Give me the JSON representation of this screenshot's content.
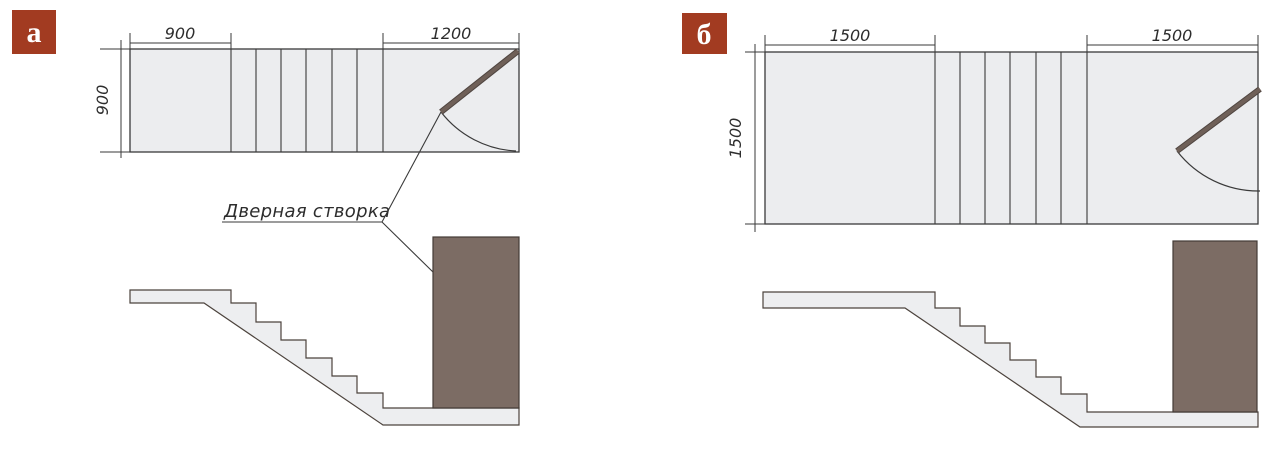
{
  "figures": [
    {
      "label": "а",
      "plan": {
        "dim_top_left": "900",
        "dim_top_right": "1200",
        "dim_left": "900"
      },
      "callout_label": "Дверная створка"
    },
    {
      "label": "б",
      "plan": {
        "dim_top_left": "1500",
        "dim_top_right": "1500",
        "dim_left": "1500"
      }
    }
  ],
  "colors": {
    "badge_background": "#A23B21",
    "badge_text": "#FFFFFF",
    "plan_fill": "#ECEDEF",
    "section_fill": "#EDEEF0",
    "door_panel": "#7C6C64",
    "door_leaf": "#6F6058",
    "line": "#3A3A3A"
  }
}
